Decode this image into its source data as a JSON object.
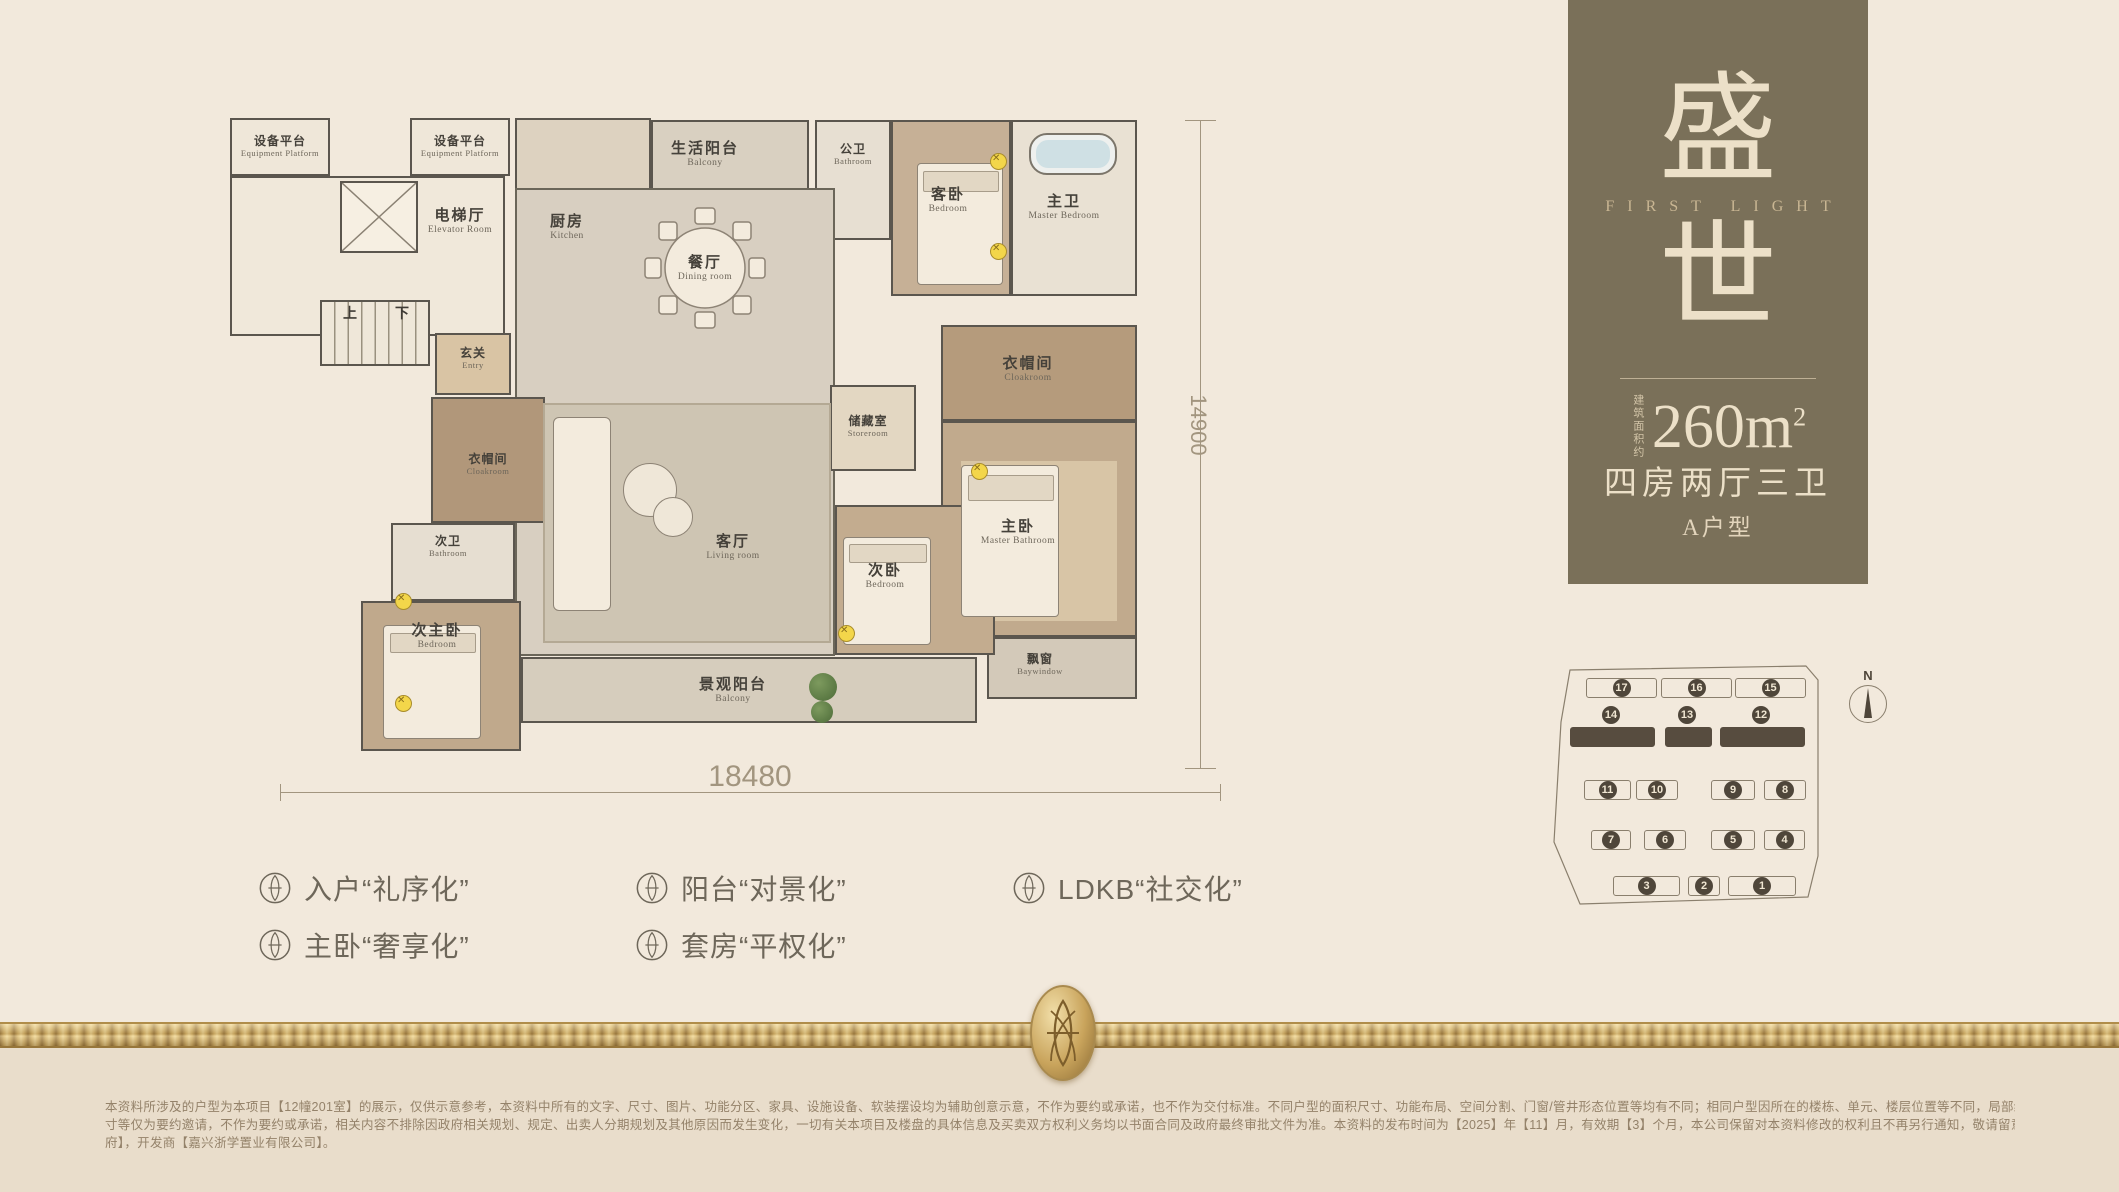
{
  "meta": {
    "bg_color": "#f2e9dc",
    "bg_lower_color": "#e9ddcb",
    "panel_brown": "#7a7059",
    "gold": "#c9a45c",
    "wall_color": "#5b564e",
    "cream_text": "#ece0c8"
  },
  "panel": {
    "title_top": "盛",
    "title_en": "FIRST LIGHT",
    "title_bottom": "世",
    "area_label": "建筑面积约",
    "area_value": "260m",
    "area_sup": "2",
    "rooms_desc": "四房两厅三卫",
    "unit_type": "A户型"
  },
  "floorplan": {
    "dim_bottom": "18480",
    "dim_right": "14900",
    "stair_up": "上",
    "stair_down": "下",
    "rooms": {
      "equip_left": {
        "cn": "设备平台",
        "en": "Equipment Platform"
      },
      "equip_right": {
        "cn": "设备平台",
        "en": "Equipment Platform"
      },
      "elevator": {
        "cn": "电梯厅",
        "en": "Elevator Room"
      },
      "entry": {
        "cn": "玄关",
        "en": "Entry"
      },
      "kitchen": {
        "cn": "厨房",
        "en": "Kitchen"
      },
      "life_balcony": {
        "cn": "生活阳台",
        "en": "Balcony"
      },
      "public_bath": {
        "cn": "公卫",
        "en": "Bathroom"
      },
      "guest_bedroom": {
        "cn": "客卧",
        "en": "Bedroom"
      },
      "master_bath": {
        "cn": "主卫",
        "en": "Master Bedroom"
      },
      "dining": {
        "cn": "餐厅",
        "en": "Dining room"
      },
      "storeroom": {
        "cn": "储藏室",
        "en": "Storeroom"
      },
      "cloakroom_master": {
        "cn": "衣帽间",
        "en": "Cloakroom"
      },
      "master_bedroom": {
        "cn": "主卧",
        "en": "Master Bathroom"
      },
      "baywindow": {
        "cn": "飘窗",
        "en": "Baywindow"
      },
      "cloakroom_left": {
        "cn": "衣帽间",
        "en": "Cloakroom"
      },
      "second_bath": {
        "cn": "次卫",
        "en": "Bathroom"
      },
      "second_master": {
        "cn": "次主卧",
        "en": "Bedroom"
      },
      "living": {
        "cn": "客厅",
        "en": "Living room"
      },
      "bedroom2": {
        "cn": "次卧",
        "en": "Bedroom"
      },
      "view_balcony": {
        "cn": "景观阳台",
        "en": "Balcony"
      }
    }
  },
  "siteplan": {
    "north_label": "N",
    "rows": [
      [
        "17",
        "16",
        "15"
      ],
      [
        "14",
        "13",
        "12"
      ],
      [
        "11",
        "10",
        "9",
        "8"
      ],
      [
        "7",
        "6",
        "5",
        "4"
      ],
      [
        "3",
        "2",
        "1"
      ]
    ]
  },
  "features": [
    {
      "label": "入户“礼序化”"
    },
    {
      "label": "主卧“奢享化”"
    },
    {
      "label": "阳台“对景化”"
    },
    {
      "label": "套房“平权化”"
    },
    {
      "label": "LDKB“社交化”"
    }
  ],
  "disclaimer": {
    "line1": "本资料所涉及的户型为本项目【12幢201室】的展示，仅供示意参考，本资料中所有的文字、尺寸、图片、功能分区、家具、设施设备、软装摆设均为辅助创意示意，不作为要约或承诺，也不作为交付标准。不同户型的面积尺寸、功能布局、空间分割、门窗/管井形态位置等均有不同；相同户型因所在的楼栋、单元、楼层位置等不同，局部结构、尺寸、面积、朝向等可能不同。本资料所有文字、数据、图片及所标尺",
    "line2": "寸等仅为要约邀请，不作为要约或承诺，相关内容不排除因政府相关规划、规定、出卖人分期规划及其他原因而发生变化，一切有关本项目及楼盘的具体信息及买卖双方权利义务均以书面合同及政府最终审批文件为准。本资料的发布时间为【2025】年【11】月，有效期【3】个月，本公司保留对本资料修改的权利且不再另行通知，敬请留意最新资料。本项目推广名【绿城·晓风明月】，核准地名为【晓风明月",
    "line3": "府】，开发商【嘉兴浙学置业有限公司】。"
  }
}
